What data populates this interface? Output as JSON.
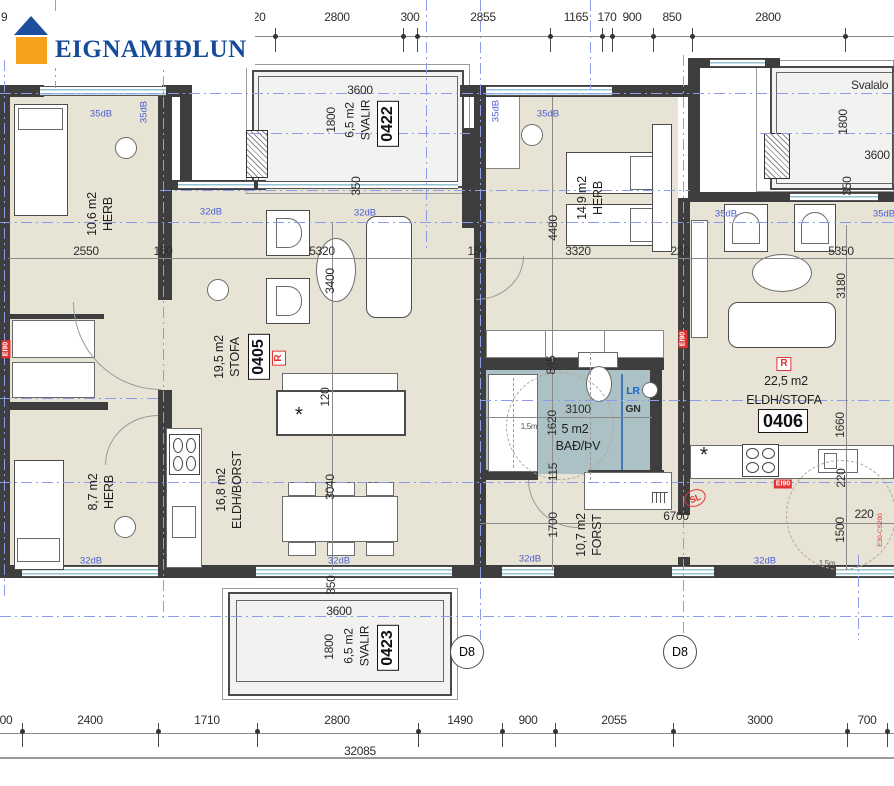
{
  "logo": {
    "brand": "EIGNAMIÐLUN"
  },
  "top_dims": [
    "820",
    "2800",
    "300",
    "2855",
    "1165",
    "170",
    "900",
    "850",
    "2800"
  ],
  "top_dim_partial": "9",
  "bottom_dims": [
    "00",
    "2400",
    "1710",
    "2800",
    "1490",
    "900",
    "2055",
    "3000",
    "700"
  ],
  "overall_dim": "32085",
  "units": {
    "u0405": {
      "area": "19,5 m2",
      "name": "STOFA",
      "id": "0405"
    },
    "u0406": {
      "area": "22,5 m2",
      "name": "ELDH/STOFA",
      "id": "0406"
    },
    "u0422": {
      "area": "6,5 m2",
      "name": "SVALIR",
      "id": "0422"
    },
    "u0423": {
      "area": "6,5 m2",
      "name": "SVALIR",
      "id": "0423"
    }
  },
  "rooms": {
    "herb_nw": {
      "area": "10,6 m2",
      "name": "HERB"
    },
    "herb_sw": {
      "area": "8,7 m2",
      "name": "HERB"
    },
    "herb_mid": {
      "area": "14,9 m2",
      "name": "HERB"
    },
    "eldh_borst": {
      "area": "16,8 m2",
      "name": "ELDH/BORST"
    },
    "bath": {
      "area": "5 m2",
      "name": "BAÐ/ÞV"
    },
    "forst": {
      "area": "10,7 m2",
      "name": "FORST"
    },
    "svalaloft": {
      "name": "Svalalo"
    }
  },
  "dims": {
    "d2550": "2550",
    "d150": "150",
    "d5320": "5320",
    "d3400": "3400",
    "d120": "120",
    "d3040": "3040",
    "d350": "350",
    "d3600": "3600",
    "d1800": "1800",
    "d4480": "4480",
    "d3320": "3320",
    "d220": "220",
    "d5350": "5350",
    "d3180": "3180",
    "d1660": "1660",
    "d1500": "1500",
    "d3100": "3100",
    "d1620": "1620",
    "d845": "845",
    "d115": "115",
    "d1700": "1700",
    "d6700": "6700",
    "radius_note": "1,5m"
  },
  "acoustic": {
    "db35": "35dB",
    "db32": "32dB"
  },
  "fire": {
    "ei90": "EI90",
    "e30": "E30-CS200",
    "sl": "SL",
    "r": "R"
  },
  "plumb": {
    "lr": "LR",
    "gn": "GN"
  },
  "markers": {
    "d8": "D8"
  },
  "symbols": {
    "star": "*"
  },
  "colors": {
    "brand_blue": "#1d4f9e",
    "brand_orange": "#f6a21d",
    "centerline_blue": "#8c9ce8",
    "acoustic_blue": "#4d5fd3",
    "fire_red": "#e23333",
    "floor_beige": "#e7e3d5",
    "bath_teal": "#abc1c5",
    "wall_dark": "#3e3e3e",
    "balcony_grey": "#f2f2f0"
  }
}
